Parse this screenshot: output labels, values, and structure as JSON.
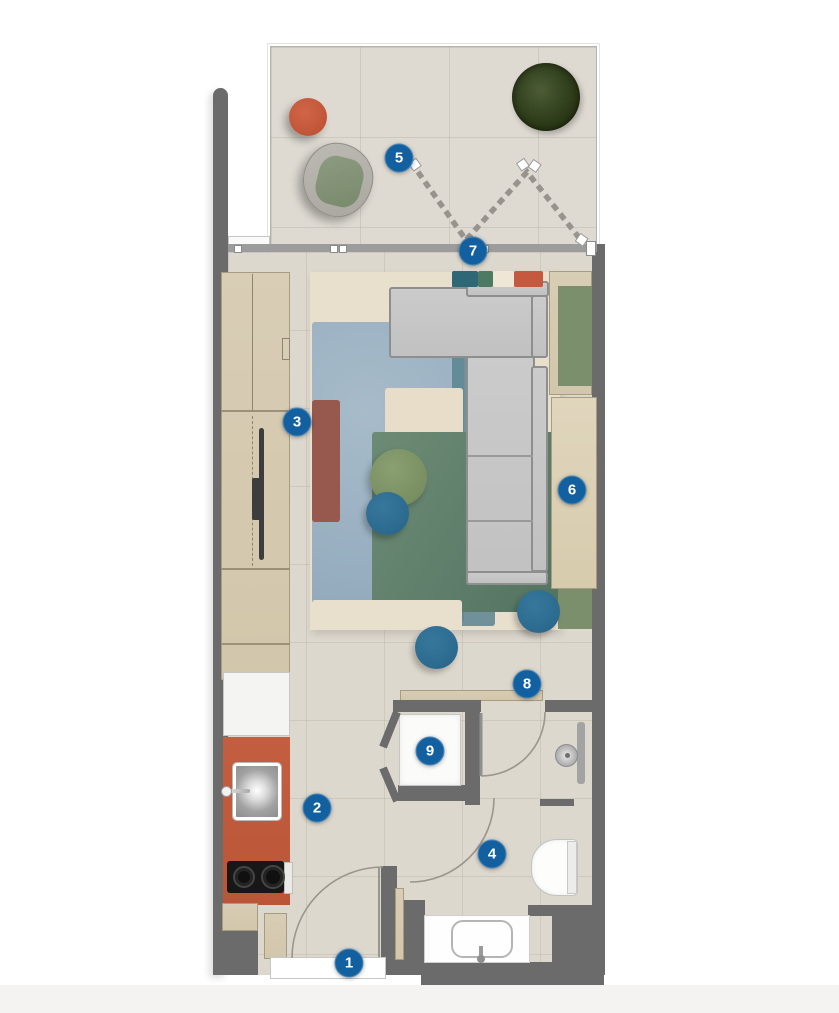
{
  "title": "studio-apartment-floor-plan",
  "markers": [
    {
      "number": "1"
    },
    {
      "number": "2"
    },
    {
      "number": "3"
    },
    {
      "number": "4"
    },
    {
      "number": "5"
    },
    {
      "number": "6"
    },
    {
      "number": "7"
    },
    {
      "number": "8"
    },
    {
      "number": "9"
    }
  ],
  "colors": {
    "marker_blue": "#12609f",
    "wall_gray": "#6b6b6b",
    "floor_tile": "#ddd8ce",
    "balcony_tile": "#dedad2",
    "wood_beige": "#d6cbb3",
    "kitchen_counter_red": "#c05b3d",
    "stool_blue": "#2d7094",
    "ottoman_green": "#7e9466",
    "tree_green": "#2f4224",
    "rug_blue": "#9eb4c4",
    "rug_green": "#67856f",
    "rug_teal": "#5a8490",
    "rug_mauve": "#97584e",
    "rug_cream": "#e9dfcd",
    "sofa_gray": "#c8c8c8",
    "panel_green": "#7b8f6d"
  }
}
